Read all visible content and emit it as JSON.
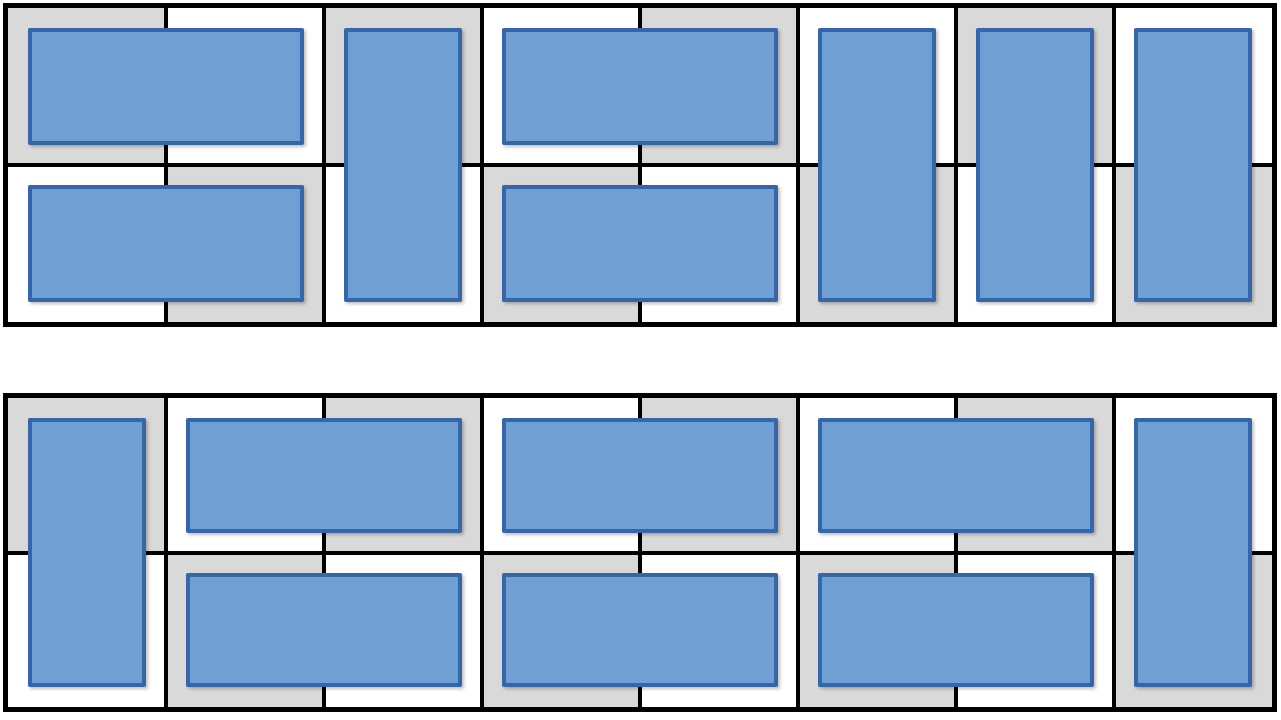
{
  "figure": {
    "description": "Two domino tilings of a 2x8 checkerboard grid",
    "board_count": 2
  },
  "colors": {
    "cell_gray": "#d9d9d9",
    "cell_white": "#ffffff",
    "grid_line": "#000000",
    "domino_fill": "#6f9fd3",
    "domino_border": "#3766a6"
  },
  "boards": [
    {
      "name": "top-tiling",
      "rows": 2,
      "cols": 8,
      "checkerboard_start": "gray",
      "dominoes": [
        {
          "orientation": "horizontal",
          "row": 0,
          "col": 0
        },
        {
          "orientation": "horizontal",
          "row": 1,
          "col": 0
        },
        {
          "orientation": "vertical",
          "row": 0,
          "col": 2
        },
        {
          "orientation": "horizontal",
          "row": 0,
          "col": 3
        },
        {
          "orientation": "horizontal",
          "row": 1,
          "col": 3
        },
        {
          "orientation": "vertical",
          "row": 0,
          "col": 5
        },
        {
          "orientation": "vertical",
          "row": 0,
          "col": 6
        },
        {
          "orientation": "vertical",
          "row": 0,
          "col": 7
        }
      ]
    },
    {
      "name": "bottom-tiling",
      "rows": 2,
      "cols": 8,
      "checkerboard_start": "gray",
      "dominoes": [
        {
          "orientation": "vertical",
          "row": 0,
          "col": 0
        },
        {
          "orientation": "horizontal",
          "row": 0,
          "col": 1
        },
        {
          "orientation": "horizontal",
          "row": 1,
          "col": 1
        },
        {
          "orientation": "horizontal",
          "row": 0,
          "col": 3
        },
        {
          "orientation": "horizontal",
          "row": 1,
          "col": 3
        },
        {
          "orientation": "horizontal",
          "row": 0,
          "col": 5
        },
        {
          "orientation": "horizontal",
          "row": 1,
          "col": 5
        },
        {
          "orientation": "vertical",
          "row": 0,
          "col": 7
        }
      ]
    }
  ],
  "layout": {
    "domino_inset_px": 20,
    "inner_grid_line_px": 4,
    "outer_border_px": 5
  }
}
